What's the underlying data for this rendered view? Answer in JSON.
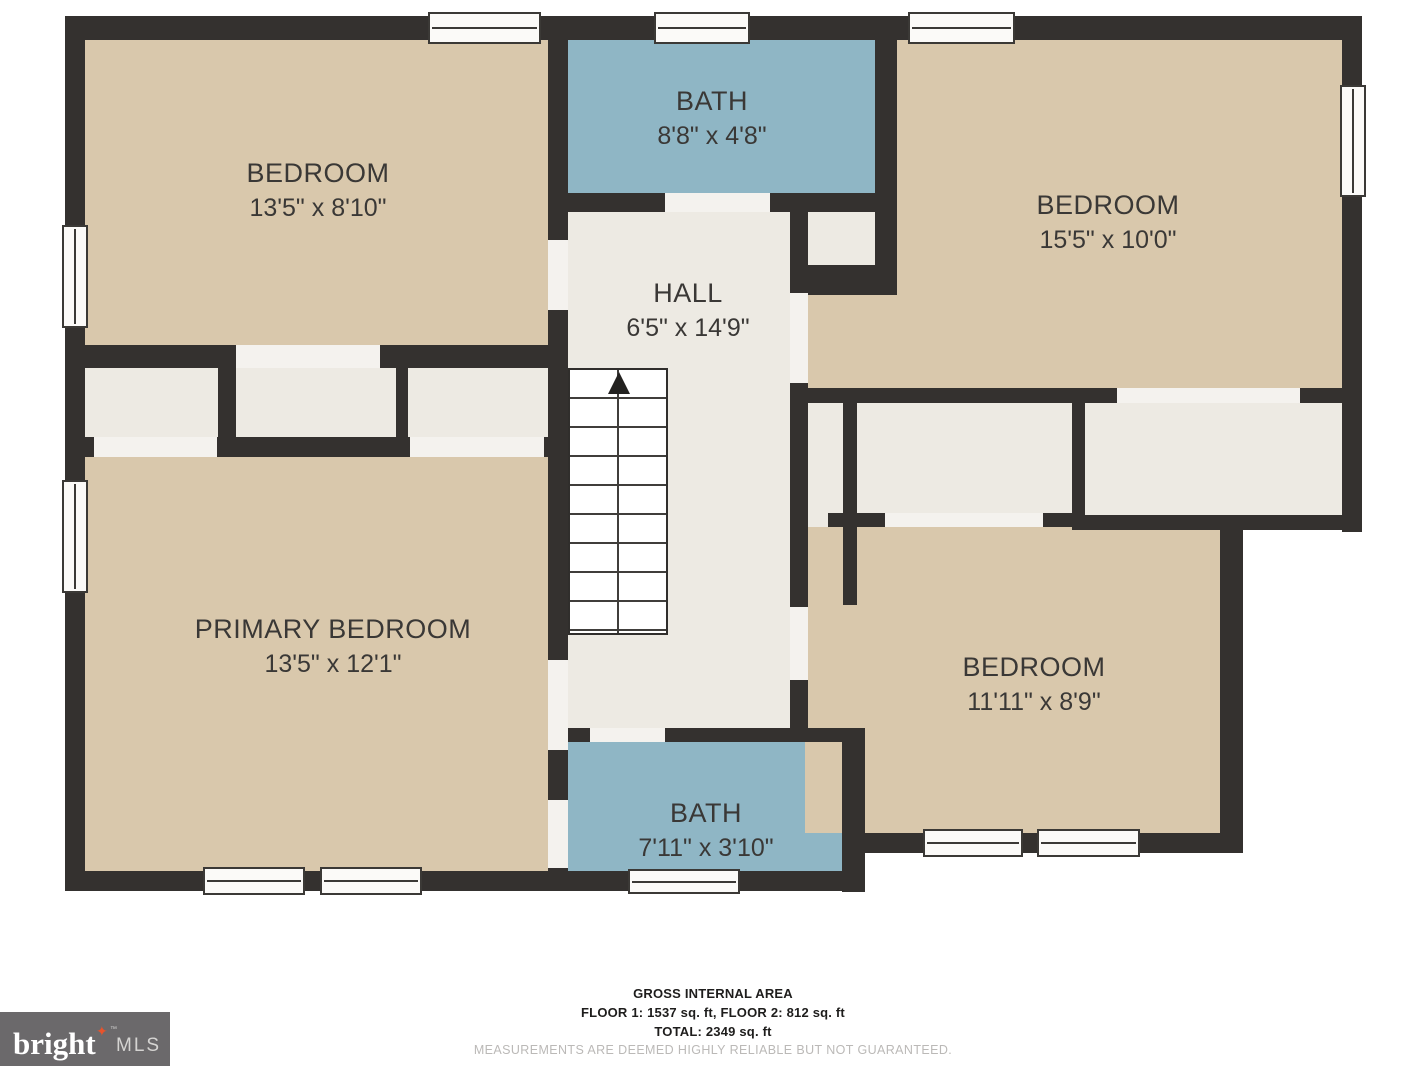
{
  "colors": {
    "wall": "#34312f",
    "room_tan": "#d9c8ac",
    "bath_blue": "#8fb6c5",
    "floor_light": "#edeae3",
    "opening": "#f4f2ee",
    "outside": "#ffffff",
    "disclaimer": "#bbb9b7",
    "logo_bg": "#6b696b",
    "accent_star": "#e8532c"
  },
  "rooms": {
    "bedroom_top_left": {
      "label": "BEDROOM",
      "dims": "13'5\" x 8'10\""
    },
    "bath_top": {
      "label": "BATH",
      "dims": "8'8\" x 4'8\""
    },
    "bedroom_top_right": {
      "label": "BEDROOM",
      "dims": "15'5\" x 10'0\""
    },
    "hall": {
      "label": "HALL",
      "dims": "6'5\" x 14'9\""
    },
    "primary_bedroom": {
      "label": "PRIMARY BEDROOM",
      "dims": "13'5\" x 12'1\""
    },
    "bath_bottom": {
      "label": "BATH",
      "dims": "7'11\" x 3'10\""
    },
    "bedroom_bottom_right": {
      "label": "BEDROOM",
      "dims": "11'11\" x 8'9\""
    }
  },
  "footer": {
    "line1": "GROSS INTERNAL AREA",
    "line2": "FLOOR 1: 1537 sq. ft, FLOOR 2: 812 sq. ft",
    "line3": "TOTAL: 2349 sq. ft",
    "disclaimer": "MEASUREMENTS ARE DEEMED HIGHLY RELIABLE BUT NOT GUARANTEED."
  },
  "logo": {
    "brand": "bright",
    "star": "✦",
    "tm": "™",
    "suffix": "MLS"
  }
}
